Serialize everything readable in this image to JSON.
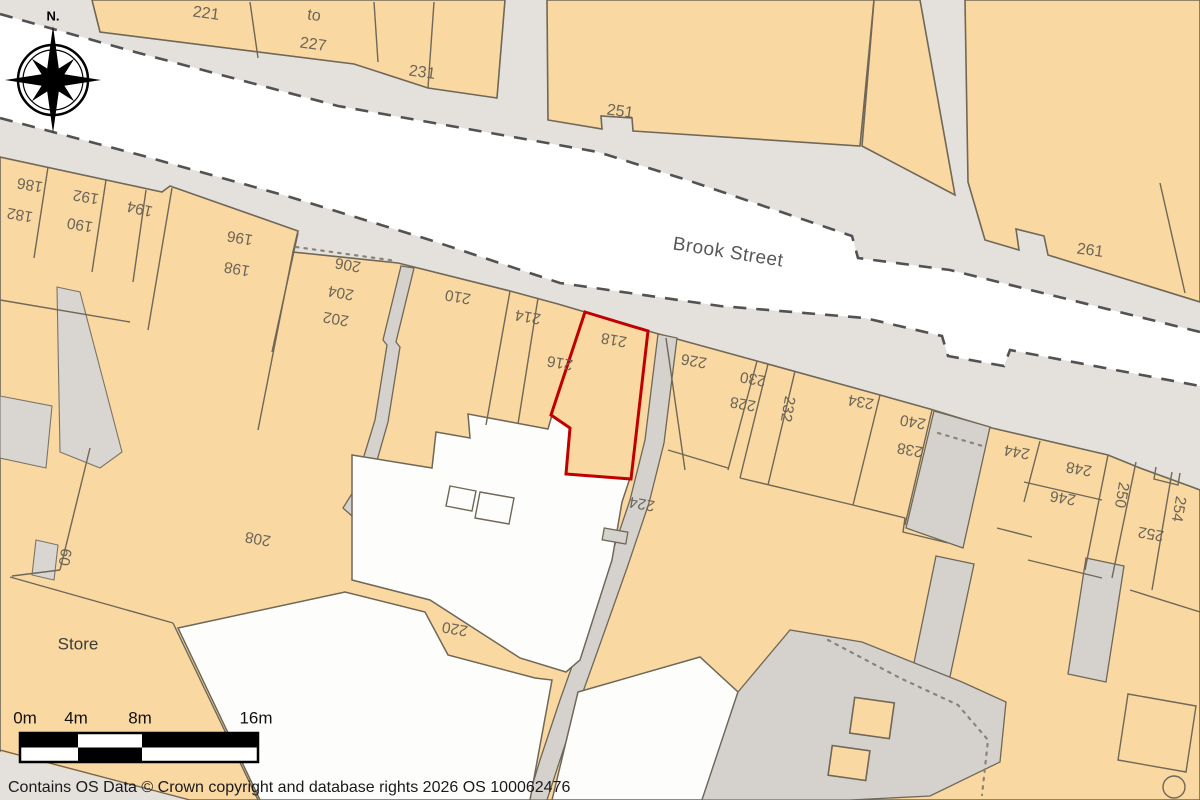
{
  "map": {
    "street_name": "Brook Street",
    "compass_label": "N.",
    "store_label": "Store",
    "selected_plot": {
      "number": "218",
      "outline_color": "#c00000"
    },
    "labels": [
      {
        "text": "221"
      },
      {
        "text": "to"
      },
      {
        "text": "227"
      },
      {
        "text": "231"
      },
      {
        "text": "251"
      },
      {
        "text": "261"
      },
      {
        "text": "186"
      },
      {
        "text": "182"
      },
      {
        "text": "192"
      },
      {
        "text": "190"
      },
      {
        "text": "194"
      },
      {
        "text": "196"
      },
      {
        "text": "198"
      },
      {
        "text": "206"
      },
      {
        "text": "204"
      },
      {
        "text": "202"
      },
      {
        "text": "210"
      },
      {
        "text": "214"
      },
      {
        "text": "216"
      },
      {
        "text": "218"
      },
      {
        "text": "226"
      },
      {
        "text": "230"
      },
      {
        "text": "228"
      },
      {
        "text": "232"
      },
      {
        "text": "234"
      },
      {
        "text": "240"
      },
      {
        "text": "238"
      },
      {
        "text": "244"
      },
      {
        "text": "248"
      },
      {
        "text": "246"
      },
      {
        "text": "250"
      },
      {
        "text": "252"
      },
      {
        "text": "254"
      },
      {
        "text": "224"
      },
      {
        "text": "220"
      },
      {
        "text": "208"
      },
      {
        "text": "60"
      }
    ],
    "scale_bar": {
      "ticks": [
        "0m",
        "4m",
        "8m",
        "16m"
      ]
    },
    "attribution": "Contains OS Data © Crown copyright and database rights 2026 OS 100062476",
    "colors": {
      "building": "#fad8a1",
      "road": "#e4e1dc",
      "path_gray": "#d5d2ce",
      "street_white": "#ffffff",
      "outline": "#6f6757",
      "selected_outline": "#c00000",
      "label_text": "#6b6557"
    }
  }
}
